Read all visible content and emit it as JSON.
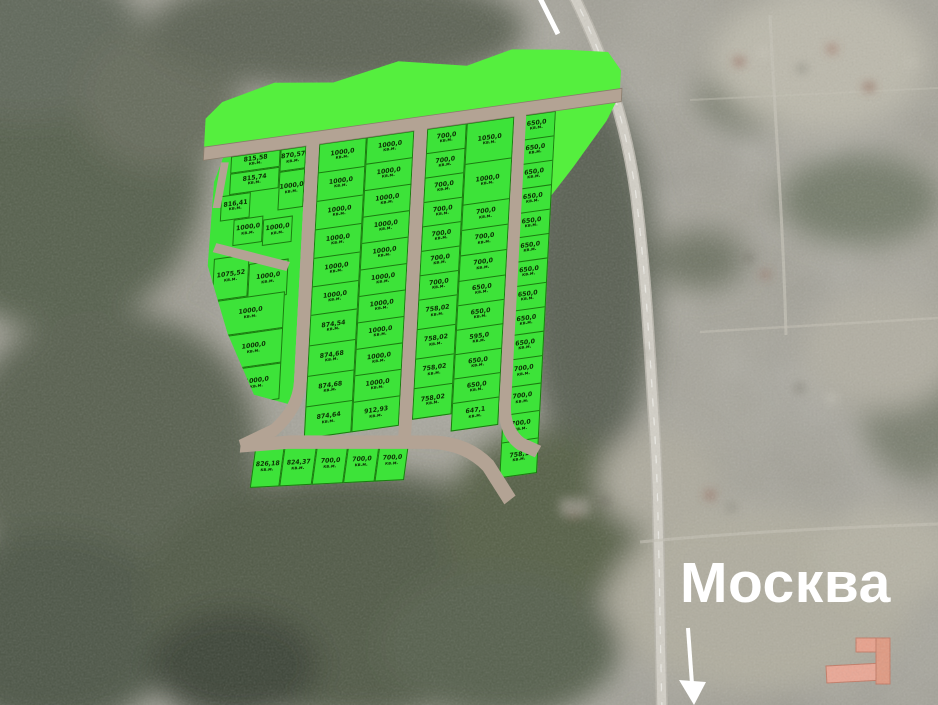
{
  "annotations": {
    "city_label": "Москва",
    "city_arrow": "arrow-pointing-down-to-highway",
    "top_edge_marker": "white-line-segment"
  },
  "unit": "кв.м.",
  "colors": {
    "plot_green": "#3de339",
    "strip_green": "#55ef3e",
    "road_tan": "#b3a394",
    "road_edge": "#8a7c6c",
    "cell_line": "#1b7a10",
    "label_ink": "#0c3004",
    "city_text": "#ffffff"
  },
  "plan": {
    "g1_cells": [
      {
        "v": "815,58",
        "x": 20,
        "y": 13,
        "w": 50,
        "h": 17
      },
      {
        "v": "870,57",
        "x": 70,
        "y": 13,
        "w": 26,
        "h": 22
      },
      {
        "v": "815,74",
        "x": 20,
        "y": 30,
        "w": 50,
        "h": 21
      },
      {
        "v": "1000,0",
        "x": 70,
        "y": 35,
        "w": 26,
        "h": 38
      },
      {
        "v": "816,41",
        "x": 12,
        "y": 51,
        "w": 30,
        "h": 25
      },
      {
        "v": "1000,0",
        "x": 26,
        "y": 76,
        "w": 30,
        "h": 26
      },
      {
        "v": "1000,0",
        "x": 56,
        "y": 80,
        "w": 30,
        "h": 26
      },
      {
        "v": "1075,52",
        "x": 8,
        "y": 112,
        "w": 36,
        "h": 42
      },
      {
        "v": "1000,0",
        "x": 44,
        "y": 122,
        "w": 40,
        "h": 36
      },
      {
        "v": "1000,0",
        "x": 14,
        "y": 154,
        "w": 68,
        "h": 36
      },
      {
        "v": "1000,0",
        "x": 24,
        "y": 190,
        "w": 58,
        "h": 34
      },
      {
        "v": "1000,0",
        "x": 34,
        "y": 224,
        "w": 48,
        "h": 36
      }
    ],
    "columns": [
      {
        "id": "g2-left",
        "x": 109,
        "y": 13,
        "w": 48,
        "cells": [
          {
            "v": "1000,0",
            "h": 28
          },
          {
            "v": "1000,0",
            "h": 28
          },
          {
            "v": "1000,0",
            "h": 28
          },
          {
            "v": "1000,0",
            "h": 28
          },
          {
            "v": "1000,0",
            "h": 28
          },
          {
            "v": "1000,0",
            "h": 28
          },
          {
            "v": "874,54",
            "h": 30
          },
          {
            "v": "874,68",
            "h": 30
          },
          {
            "v": "874,68",
            "h": 30
          },
          {
            "v": "874,64",
            "h": 30
          }
        ]
      },
      {
        "id": "g2-right",
        "x": 157,
        "y": 13,
        "w": 48,
        "cells": [
          {
            "v": "1000,0",
            "h": 26
          },
          {
            "v": "1000,0",
            "h": 26
          },
          {
            "v": "1000,0",
            "h": 26
          },
          {
            "v": "1000,0",
            "h": 26
          },
          {
            "v": "1000,0",
            "h": 26
          },
          {
            "v": "1000,0",
            "h": 26
          },
          {
            "v": "1000,0",
            "h": 26
          },
          {
            "v": "1000,0",
            "h": 26
          },
          {
            "v": "1000,0",
            "h": 26
          },
          {
            "v": "1000,0",
            "h": 26
          },
          {
            "v": "912,93",
            "h": 28
          }
        ]
      },
      {
        "id": "g3-left",
        "x": 218,
        "y": 13,
        "w": 40,
        "cells": [
          {
            "v": "700,0",
            "h": 24
          },
          {
            "v": "700,0",
            "h": 24
          },
          {
            "v": "700,0",
            "h": 24
          },
          {
            "v": "700,0",
            "h": 24
          },
          {
            "v": "700,0",
            "h": 24
          },
          {
            "v": "700,0",
            "h": 24
          },
          {
            "v": "700,0",
            "h": 24
          },
          {
            "v": "758,02",
            "h": 29
          },
          {
            "v": "758,02",
            "h": 29
          },
          {
            "v": "758,02",
            "h": 29
          },
          {
            "v": "758,02",
            "h": 29
          }
        ]
      },
      {
        "id": "g3-right",
        "x": 258,
        "y": 13,
        "w": 48,
        "cells": [
          {
            "v": "1050,0",
            "h": 40
          },
          {
            "v": "1000,0",
            "h": 40
          },
          {
            "v": "700,0",
            "h": 25
          },
          {
            "v": "700,0",
            "h": 25
          },
          {
            "v": "700,0",
            "h": 25
          },
          {
            "v": "650,0",
            "h": 24
          },
          {
            "v": "650,0",
            "h": 24
          },
          {
            "v": "595,0",
            "h": 24
          },
          {
            "v": "650,0",
            "h": 24
          },
          {
            "v": "650,0",
            "h": 24
          },
          {
            "v": "647,1",
            "h": 26
          }
        ]
      },
      {
        "id": "g4",
        "x": 310,
        "y": 13,
        "w": 38,
        "cells": [
          {
            "v": "650,0",
            "h": 24
          },
          {
            "v": "650,0",
            "h": 24
          },
          {
            "v": "650,0",
            "h": 24
          },
          {
            "v": "650,0",
            "h": 24
          },
          {
            "v": "650,0",
            "h": 24
          },
          {
            "v": "650,0",
            "h": 24
          },
          {
            "v": "650,0",
            "h": 24
          },
          {
            "v": "650,0",
            "h": 24
          },
          {
            "v": "650,0",
            "h": 24
          },
          {
            "v": "650,0",
            "h": 24
          },
          {
            "v": "700,0",
            "h": 27
          },
          {
            "v": "700,0",
            "h": 27
          },
          {
            "v": "700,0",
            "h": 27
          },
          {
            "v": "758,1",
            "h": 33
          }
        ]
      }
    ],
    "bottom_row": [
      {
        "v": "826,18",
        "w": 30
      },
      {
        "v": "824,37",
        "w": 33
      },
      {
        "v": "700,0",
        "w": 32
      },
      {
        "v": "700,0",
        "w": 32
      },
      {
        "v": "700,0",
        "w": 30
      }
    ]
  }
}
